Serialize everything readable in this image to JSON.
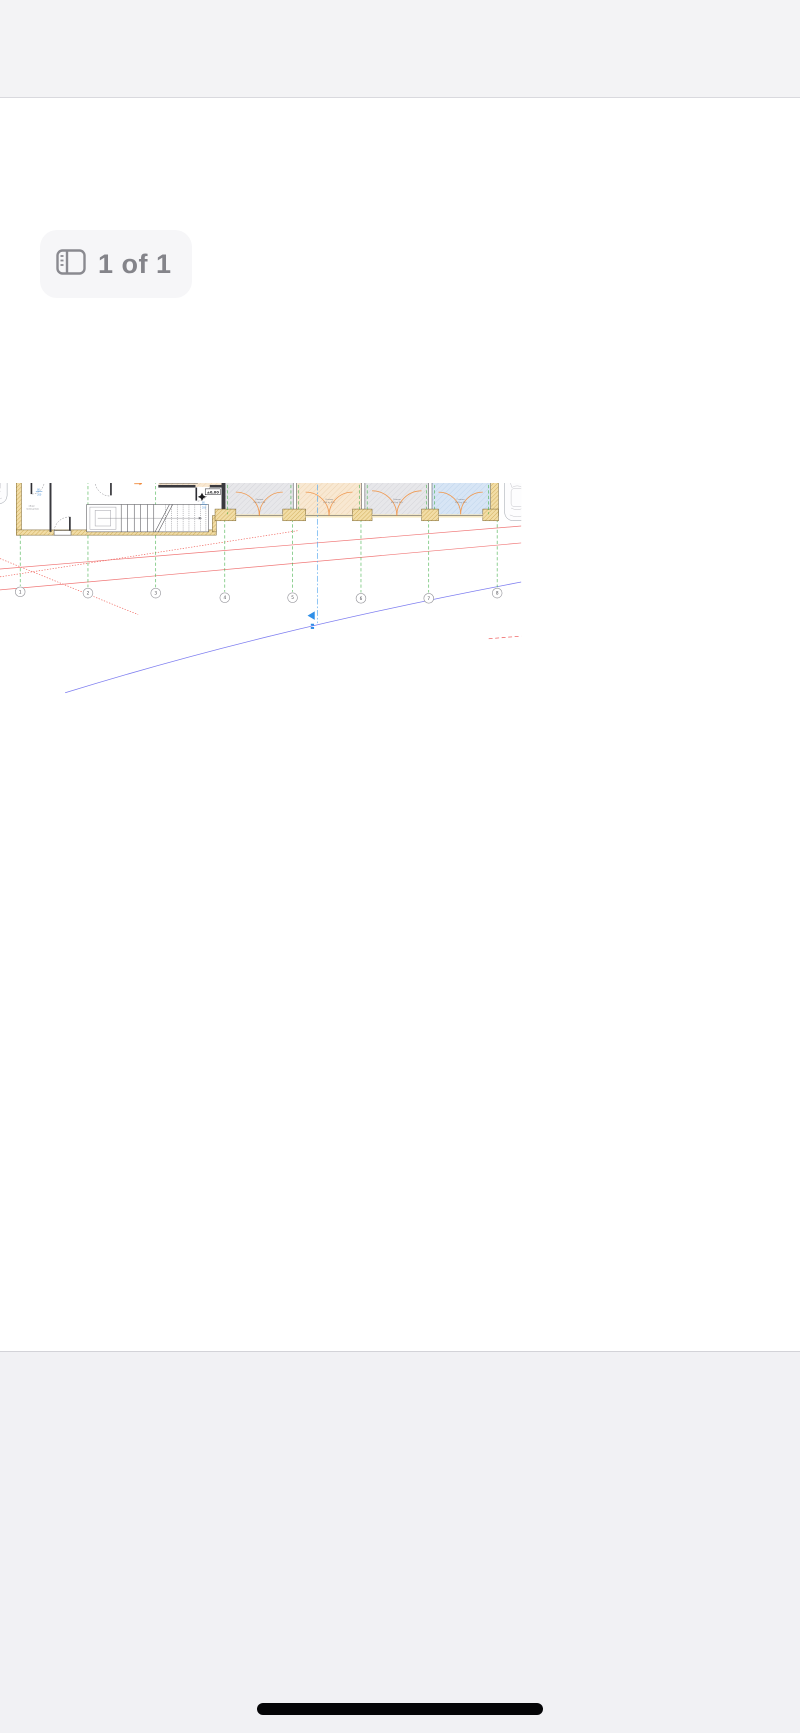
{
  "chrome": {
    "page_indicator": "1 of 1"
  },
  "plan": {
    "title": "ВАРИАНТ 2",
    "subtitle": "ЗП 239,57 m²",
    "axes": [
      "1",
      "2",
      "3",
      "4",
      "5",
      "6",
      "7",
      "8"
    ],
    "labels": {
      "apartment1_area": "43,55 m²",
      "apartment2_area": "37,90 m²",
      "level_mark": "±0,00",
      "common_room_line1": "общи",
      "common_room_line2": "помещения",
      "door_width": "80",
      "door_height": "200"
    },
    "garages": [
      {
        "area": "38,14 m²"
      },
      {
        "area": "38,14 m²"
      },
      {
        "area": "30,07 m²"
      },
      {
        "area": "30,07 m²"
      }
    ],
    "garage_door": {
      "line1": "Custom",
      "line2": "250 by 210"
    },
    "colors": {
      "axis_green": "#43b04a",
      "centerline_blue": "#54a8ef",
      "site_line_blue": "#7d7df0",
      "site_line_red": "#f07878",
      "wall_ocher": "#e8c96a",
      "floor_blue": "#d7e5f5",
      "floor_peach": "#f8e8d2",
      "floor_gray": "#e7e7ea",
      "door_orange": "#f09a52"
    }
  }
}
